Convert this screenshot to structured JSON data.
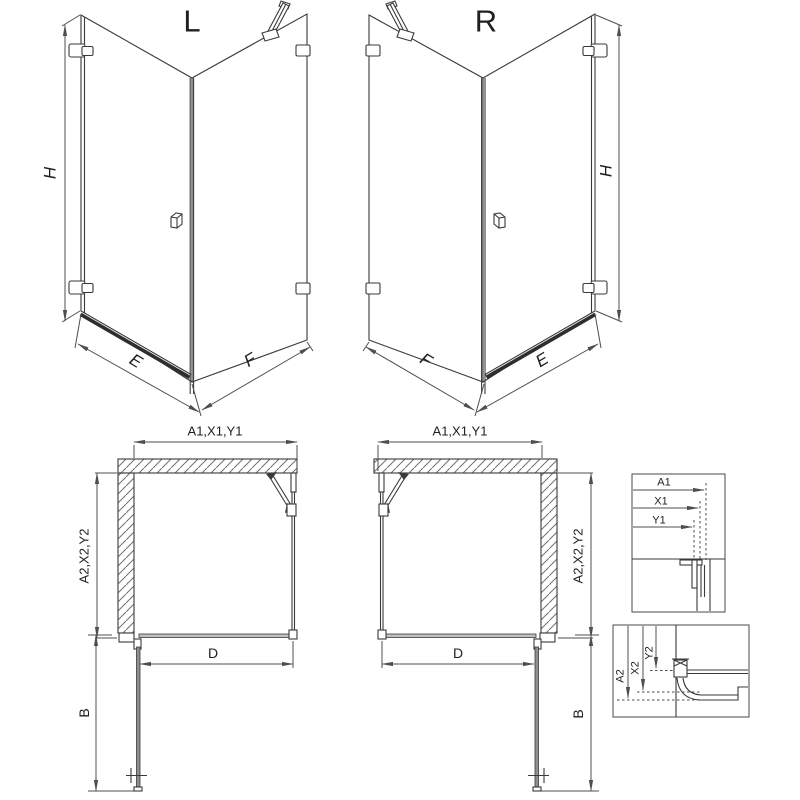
{
  "colors": {
    "background": "#ffffff",
    "outline": "#3a3a3a",
    "dimension_lines": "#4f4f4f",
    "bottom_rail": "#2e2e2e",
    "wall_hatch": "#707070",
    "plan_door_fill": "#8f8f8f",
    "plan_threshold_fill": "#c0c0c0"
  },
  "iso_left": {
    "label": "L",
    "dim_height": "H",
    "dim_door": "E",
    "dim_side": "F"
  },
  "iso_right": {
    "label": "R",
    "dim_height": "H",
    "dim_door": "E",
    "dim_side": "F"
  },
  "plan_left": {
    "dim_top": "A1,X1,Y1",
    "dim_side": "A2,X2,Y2",
    "dim_opening": "D",
    "dim_door": "B"
  },
  "plan_right": {
    "dim_top": "A1,X1,Y1",
    "dim_side": "A2,X2,Y2",
    "dim_opening": "D",
    "dim_door": "B"
  },
  "detail_top": {
    "dim_a1": "A1",
    "dim_x1": "X1",
    "dim_y1": "Y1"
  },
  "detail_bottom": {
    "dim_a2": "A2",
    "dim_x2": "X2",
    "dim_y2": "Y2"
  }
}
